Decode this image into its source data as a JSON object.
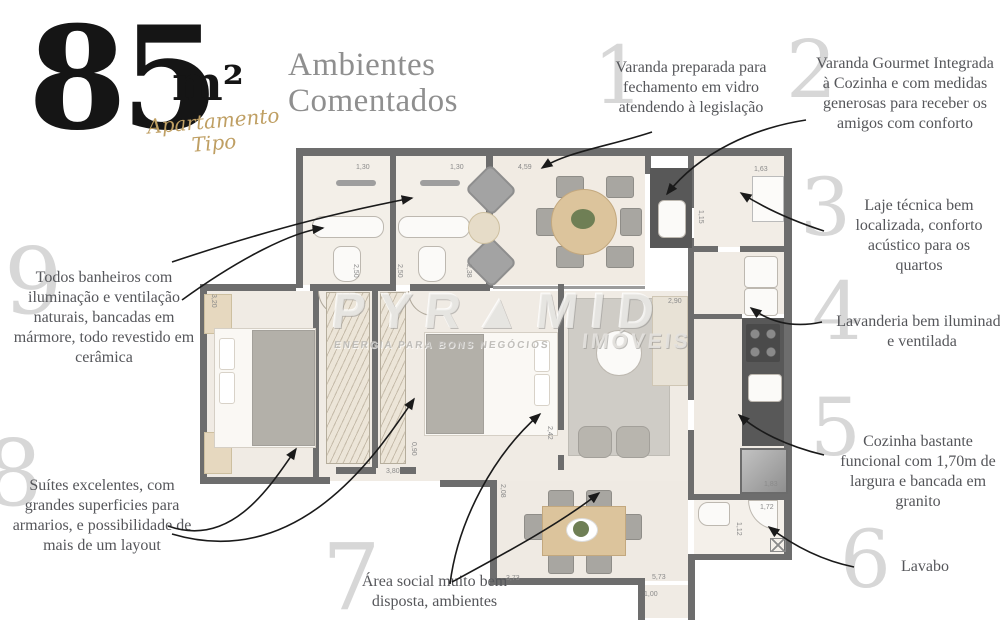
{
  "header": {
    "area_value": "85",
    "area_unit": "m²",
    "subtitle_line1": "Apartamento",
    "subtitle_line2": "Tipo"
  },
  "title": {
    "line1": "Ambientes",
    "line2": "Comentados"
  },
  "callouts": [
    {
      "number": "1",
      "text": "Varanda preparada para fechamento em vidro atendendo à legislação"
    },
    {
      "number": "2",
      "text": "Varanda Gourmet Integrada à Cozinha e com medidas generosas para receber os amigos com conforto"
    },
    {
      "number": "3",
      "text": "Laje técnica bem localizada, conforto acústico para os quartos"
    },
    {
      "number": "4",
      "text": "Lavanderia bem iluminada e ventilada"
    },
    {
      "number": "5",
      "text": "Cozinha bastante funcional com 1,70m de largura e bancada em granito"
    },
    {
      "number": "6",
      "text": "Lavabo"
    },
    {
      "number": "7",
      "text": "Área social muito bem disposta, ambientes"
    },
    {
      "number": "8",
      "text": "Suítes excelentes, com grandes superficies para armarios, e possibilidade de mais de um layout"
    },
    {
      "number": "9",
      "text": "Todos banheiros com iluminação e ventilação naturais, bancadas em mármore, todo revestido em cerâmica"
    }
  ],
  "watermark": {
    "brand": "PYR▲MID",
    "tagline": "ENERGIA PARA BONS NEGÓCIOS",
    "suffix": "IMÓVEIS"
  },
  "floorplan": {
    "dims": [
      "1,30",
      "1,30",
      "4,59",
      "1,63",
      "1,15",
      "3,20",
      "2,50",
      "2,50",
      "2,38",
      "2,90",
      "2,42",
      "0,90",
      "3,80",
      "2,08",
      "3,73",
      "1,00",
      "1,83",
      "1,72",
      "1,12",
      "5,73"
    ]
  }
}
